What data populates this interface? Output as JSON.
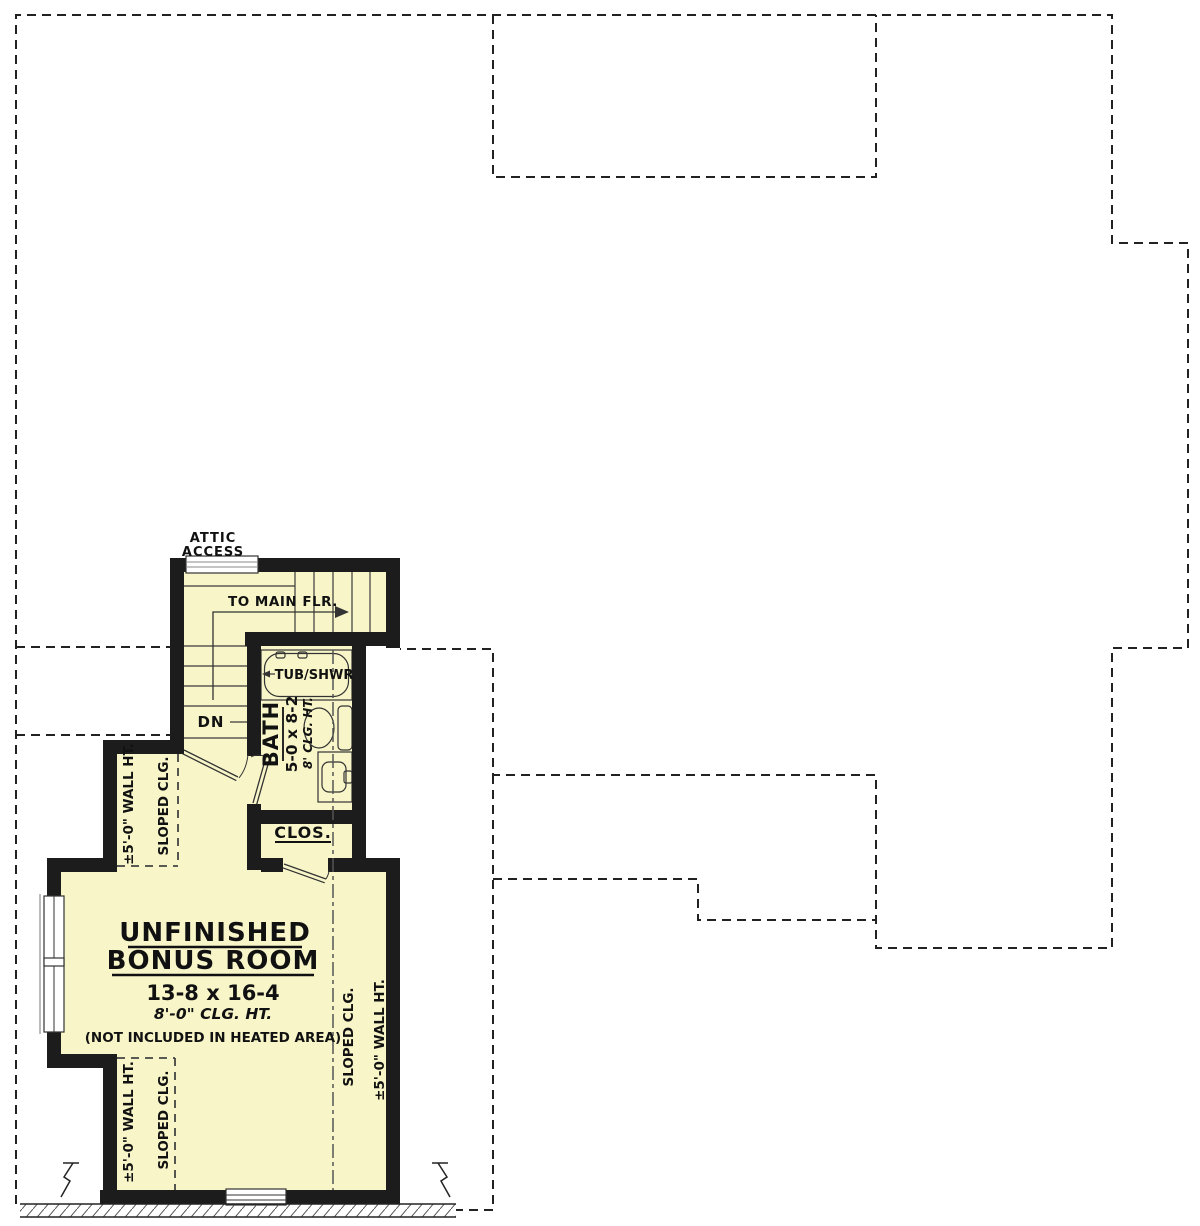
{
  "plan": {
    "labels": {
      "attic_line1": "ATTIC",
      "attic_line2": "ACCESS",
      "to_main_floor": "TO MAIN FLR.",
      "down": "DN"
    },
    "bath": {
      "tub": "TUB/SHWR",
      "name": "BATH",
      "dims": "5-0 x 8-2",
      "ceiling": "8' CLG. HT."
    },
    "closet": {
      "name": "CLOS."
    },
    "bonus_room": {
      "name_line1": "UNFINISHED",
      "name_line2": "BONUS ROOM",
      "dims": "13-8 x 16-4",
      "ceiling": "8'-0\" CLG. HT.",
      "note": "(NOT INCLUDED IN HEATED AREA)"
    },
    "slopes": {
      "sloped_clg": "SLOPED CLG.",
      "wall_ht": "±5'-0\" WALL HT."
    },
    "colors": {
      "room_fill": "#F8F6C9",
      "wall": "#1C1C1C",
      "dashed_line": "#222222"
    }
  }
}
